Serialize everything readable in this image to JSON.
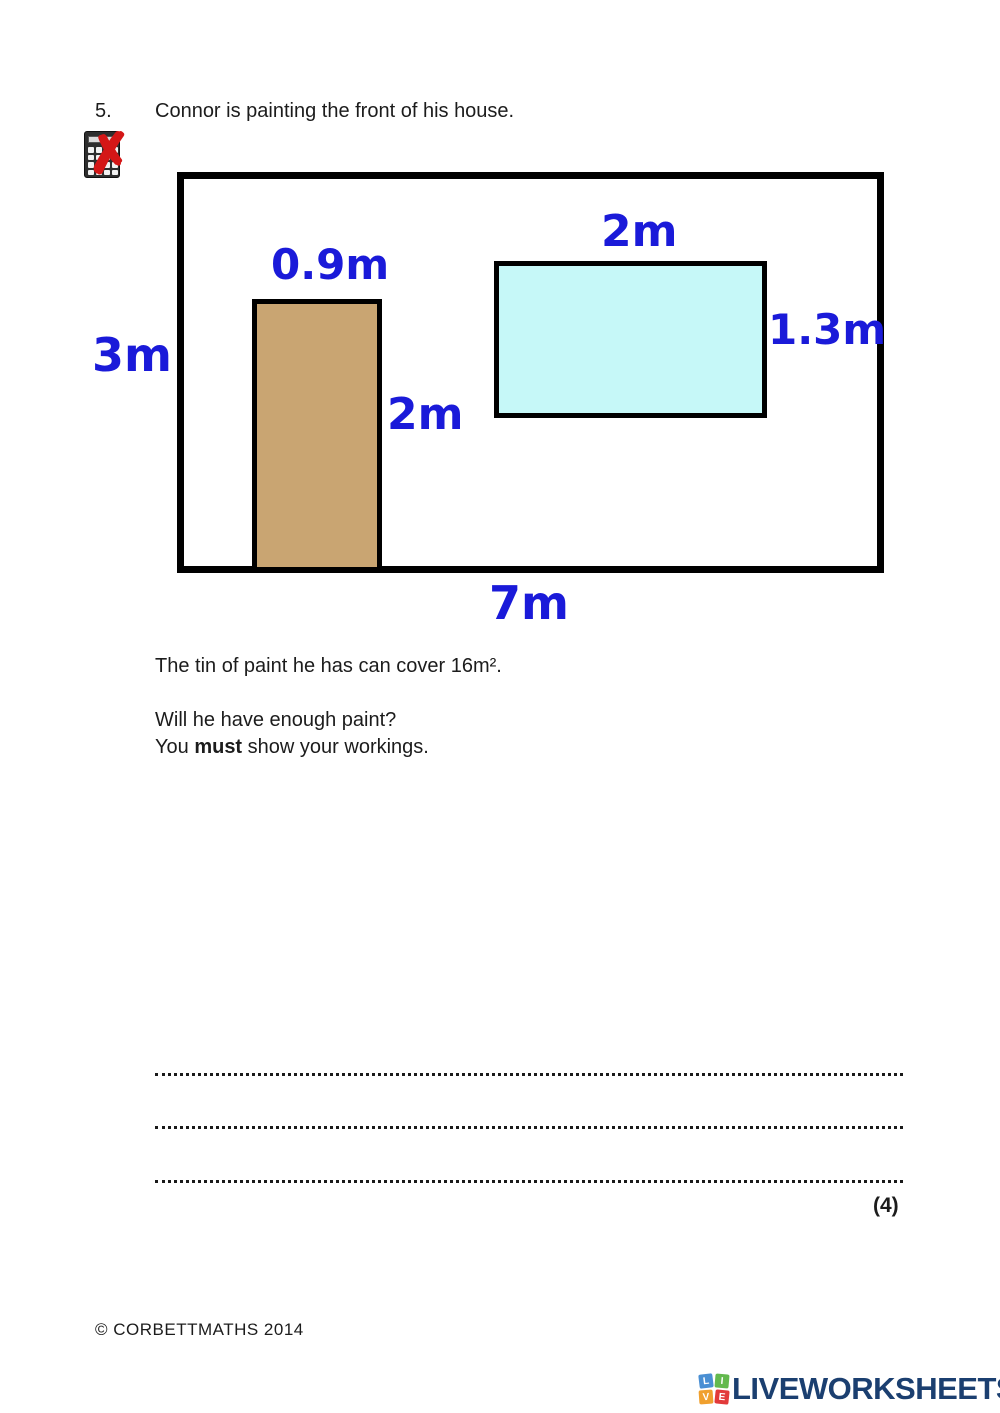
{
  "question": {
    "number": "5.",
    "text": "Connor is painting the front of his house.",
    "no_calculator_icon": "calculator with red cross (non-calculator question)"
  },
  "diagram": {
    "type": "compound-rectangles",
    "description": "Front of house: large rectangle 7m by 3m containing a door 0.9m by 2m and a window 2m by 1.3m",
    "house": {
      "width_label": "7m",
      "height_label": "3m"
    },
    "door": {
      "width_label": "0.9m",
      "height_label": "2m",
      "fill": "#c9a572"
    },
    "window": {
      "width_label": "2m",
      "height_label": "1.3m",
      "fill": "#c6f8f8"
    },
    "label_color": "#1a1ad9",
    "outline_color": "#000000"
  },
  "body": {
    "paint_info": "The tin of paint he has can cover 16m².",
    "question_line": "Will he have enough paint?",
    "workings_prefix": "You ",
    "workings_bold": "must",
    "workings_suffix": " show your workings.",
    "marks": "(4)"
  },
  "footer": {
    "copyright": "© CORBETTMATHS 2014"
  },
  "branding": {
    "logo_text": "LIVEWORKSHEETS",
    "logo_text_color": "#1b3f70",
    "logo_squares": [
      {
        "letter": "L",
        "color": "#4a8fd3"
      },
      {
        "letter": "I",
        "color": "#63b94e"
      },
      {
        "letter": "V",
        "color": "#f0a02e"
      },
      {
        "letter": "E",
        "color": "#e23a3a"
      }
    ]
  }
}
